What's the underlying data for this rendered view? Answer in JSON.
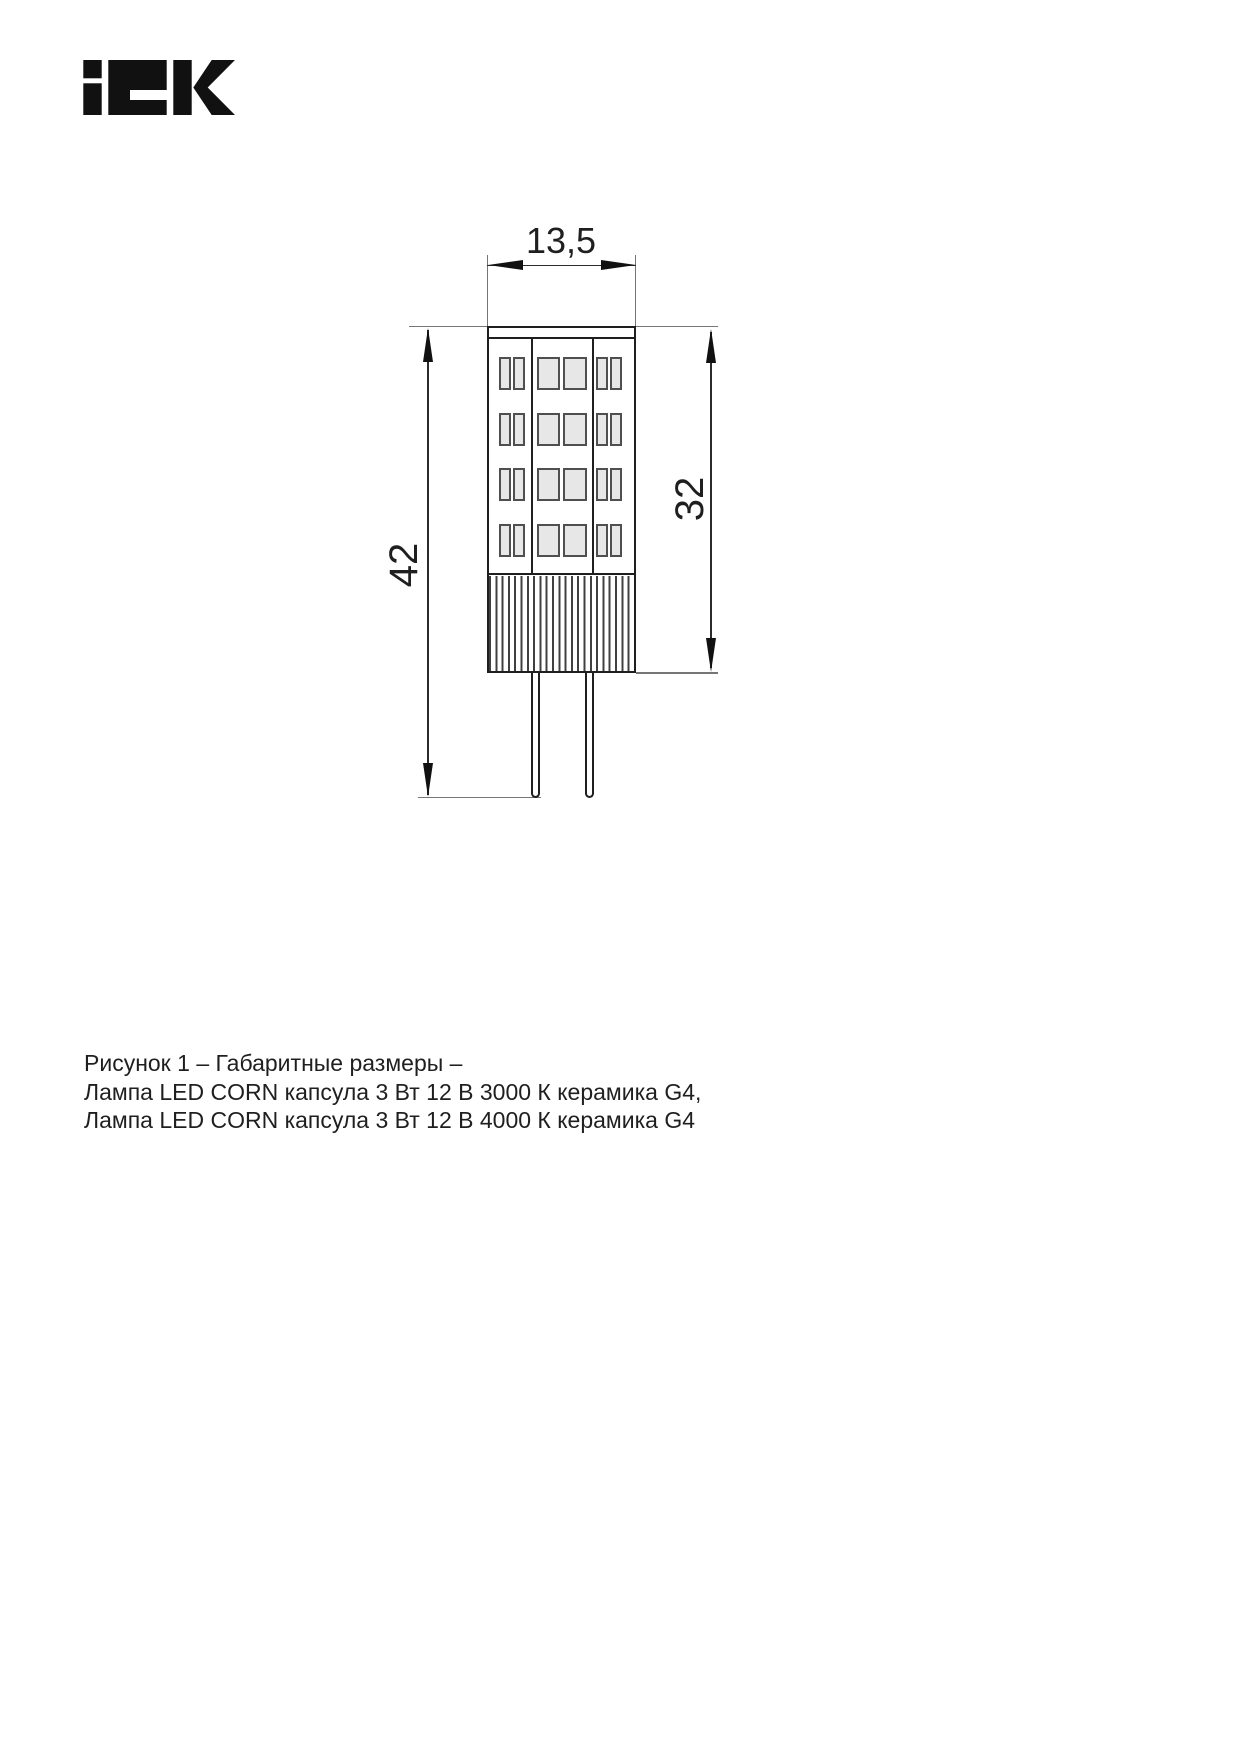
{
  "page": {
    "background": "#ffffff"
  },
  "logo": {
    "brand": "IEK",
    "color": "#111111"
  },
  "figure": {
    "dimensions": {
      "width_mm": "13,5",
      "total_height_mm": "42",
      "body_height_mm": "32"
    },
    "led_grid": {
      "rows": 4,
      "chips_per_row": 6
    },
    "colors": {
      "outline": "#1f1f1f",
      "dim_line": "#2b2b2b",
      "extension_line": "#767676",
      "chip_fill": "#e7e7e7",
      "chip_border": "#4f4f4f"
    }
  },
  "caption": {
    "line1": "Рисунок 1 – Габаритные размеры –",
    "line2": "Лампа LED CORN капсула 3 Вт 12 В 3000 К керамика G4,",
    "line3": "Лампа LED CORN капсула 3 Вт 12 В 4000 К керамика G4"
  }
}
